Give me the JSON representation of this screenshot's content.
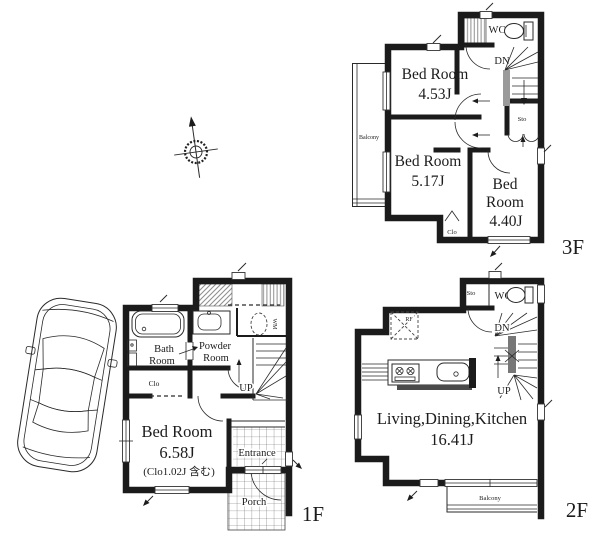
{
  "colors": {
    "wall": "#1b1b1b",
    "hatch_grey": "#8f8f8f",
    "text": "#1c1c1c",
    "stair_rail": "#777777",
    "counter_shadow": "#4a4a4a"
  },
  "floor3": {
    "label": "3F",
    "bedroom1_name": "Bed Room",
    "bedroom1_size": "4.53J",
    "bedroom2_name": "Bed Room",
    "bedroom2_size": "5.17J",
    "bedroom3_line1": "Bed",
    "bedroom3_line2": "Room",
    "bedroom3_size": "4.40J",
    "wc": "WC",
    "down": "DN",
    "storage": "Sto",
    "closet": "Clo",
    "balcony": "Balcony"
  },
  "floor2": {
    "label": "2F",
    "ldk_name": "Living,Dining,Kitchen",
    "ldk_size": "16.41J",
    "wc": "WC",
    "down": "DN",
    "up": "UP",
    "storage": "Sto",
    "fridge": "RF",
    "balcony": "Balcony"
  },
  "floor1": {
    "label": "1F",
    "bath_line1": "Bath",
    "bath_line2": "Room",
    "powder_line1": "Powder",
    "powder_line2": "Room",
    "closet": "Clo",
    "washer": "WM",
    "up": "UP",
    "entrance": "Entrance",
    "porch": "Porch",
    "bedroom_name": "Bed Room",
    "bedroom_size": "6.58J",
    "bedroom_note": "(Clo1.02J 含む)"
  }
}
